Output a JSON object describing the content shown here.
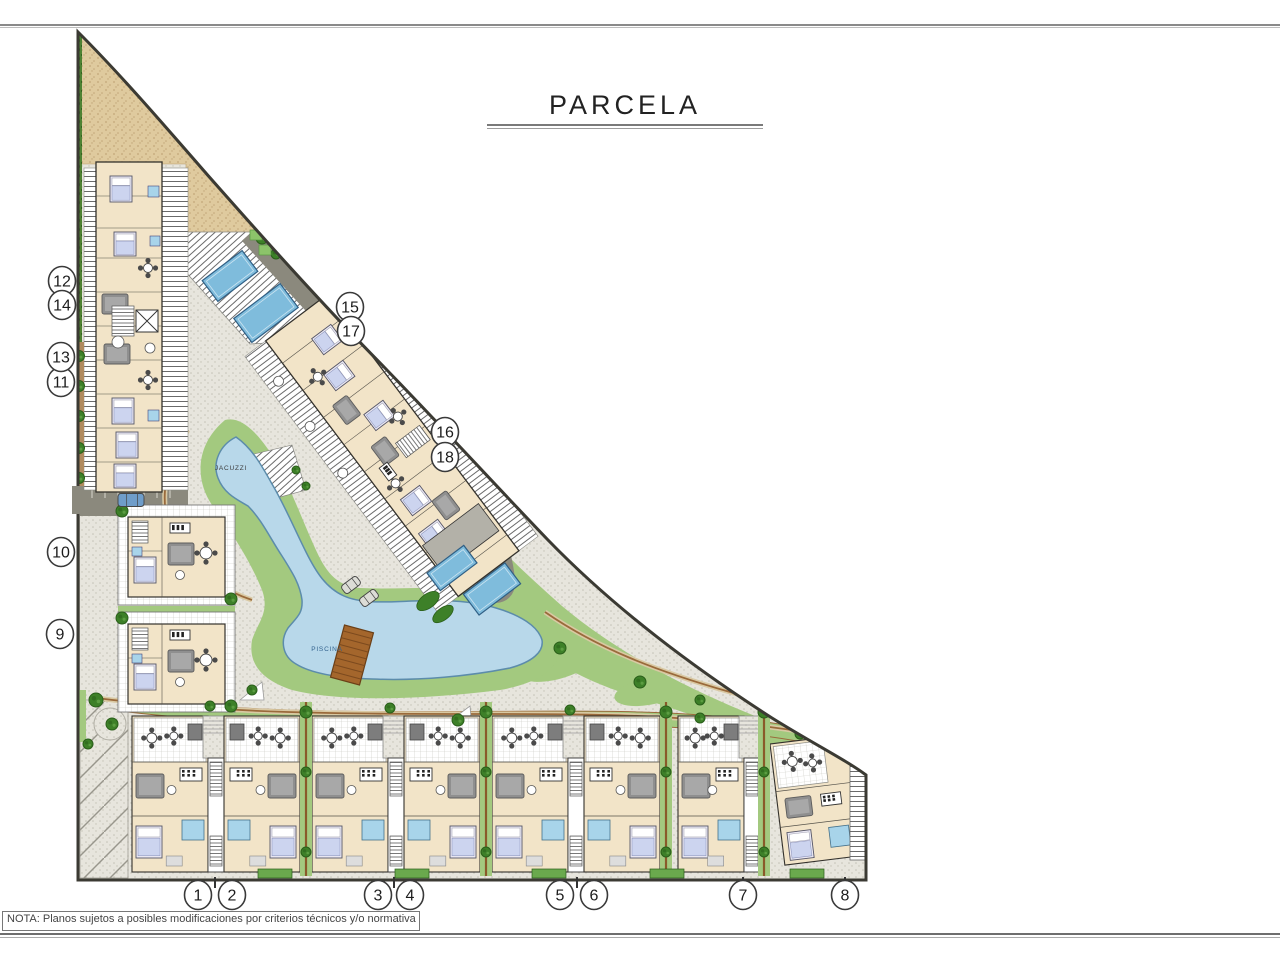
{
  "title": "PARCELA",
  "note_text": "NOTA: Planos sujetos a posibles modificaciones por criterios técnicos y/o normativa sectorial.",
  "area_labels": [
    {
      "text": "PISCINA",
      "x": 327,
      "y": 651,
      "color": "#33628e"
    },
    {
      "text": "JACUZZI",
      "x": 231,
      "y": 470,
      "color": "#3d3d3d"
    }
  ],
  "unit_callouts": [
    {
      "label": "1",
      "x": 198,
      "y": 895
    },
    {
      "label": "2",
      "x": 232,
      "y": 895
    },
    {
      "label": "3",
      "x": 378,
      "y": 895
    },
    {
      "label": "4",
      "x": 410,
      "y": 895
    },
    {
      "label": "5",
      "x": 560,
      "y": 895
    },
    {
      "label": "6",
      "x": 594,
      "y": 895
    },
    {
      "label": "7",
      "x": 743,
      "y": 895
    },
    {
      "label": "8",
      "x": 845,
      "y": 895
    },
    {
      "label": "9",
      "x": 60,
      "y": 634
    },
    {
      "label": "10",
      "x": 61,
      "y": 552
    },
    {
      "label": "11",
      "x": 61,
      "y": 382
    },
    {
      "label": "13",
      "x": 61,
      "y": 357
    },
    {
      "label": "12",
      "x": 62,
      "y": 281
    },
    {
      "label": "14",
      "x": 62,
      "y": 305
    },
    {
      "label": "15",
      "x": 350,
      "y": 307
    },
    {
      "label": "17",
      "x": 351,
      "y": 331
    },
    {
      "label": "16",
      "x": 445,
      "y": 432
    },
    {
      "label": "18",
      "x": 445,
      "y": 457
    }
  ],
  "colors": {
    "sand": "#dfca9e",
    "sand_dot": "#c2a678",
    "pave": "#e7e5dd",
    "pave_dot": "#c3c1b6",
    "road": "#8b897d",
    "road_dark": "#6f6d66",
    "grass": "#a3c97f",
    "grass_dark": "#6aa94d",
    "tree": "#3d8028",
    "tree_dark": "#2a5e1a",
    "hedge_bg": "#4f8233",
    "hedge_dot": "#33621f",
    "water": "#7fbcdc",
    "water_edge": "#2f5f85",
    "lagoon": "#b8d8ea",
    "lagoon_edge": "#5c8cab",
    "building": "#f2e4c8",
    "building_line": "#33312c",
    "terrace": "#ffffff",
    "furniture": "#8f8f8f",
    "bed": "#ccd4ef",
    "bath": "#a8d4ea",
    "path_edge": "#9a6a3b",
    "bridge": "#a4662c",
    "boundary": "#3b3a33",
    "frame": "#8c8c8c",
    "text": "#1c1c1c"
  }
}
